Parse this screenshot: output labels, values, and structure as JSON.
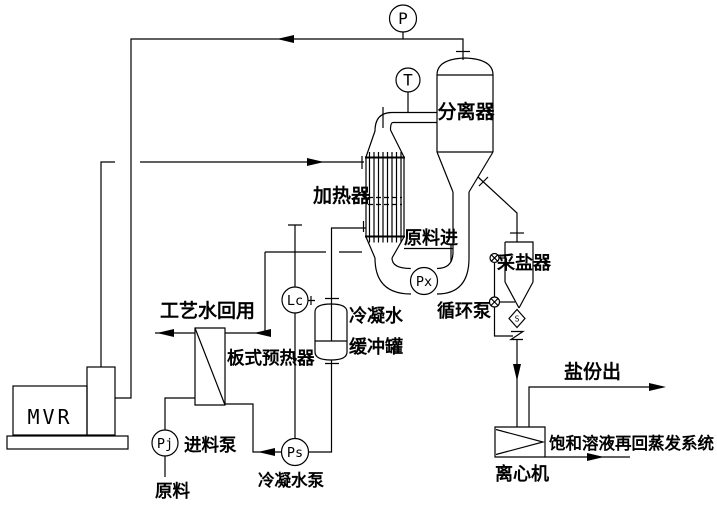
{
  "colors": {
    "line": "#000000",
    "background": "#ffffff"
  },
  "instruments": {
    "pressure": {
      "tag": "P"
    },
    "temperature": {
      "tag": "T"
    },
    "circulation_pump": {
      "tag": "Px",
      "label": "循环泵"
    },
    "level_controller": {
      "tag": "Lc"
    },
    "condensate_pump": {
      "tag": "Ps",
      "label": "冷凝水泵"
    },
    "feed_pump": {
      "tag": "Pj",
      "label": "进料泵"
    }
  },
  "equipment": {
    "mvr": {
      "label": "MVR"
    },
    "heater": {
      "label": "加热器"
    },
    "separator": {
      "label": "分离器"
    },
    "plate_preheater": {
      "label": "板式预热器"
    },
    "condensate_buffer_tank": {
      "label_line1": "冷凝水",
      "label_line2": "缓冲罐"
    },
    "salt_collector": {
      "label": "采盐器"
    },
    "centrifuge": {
      "label": "离心机"
    }
  },
  "streams": {
    "feed_in": {
      "label": "原料进"
    },
    "raw_material": {
      "label": "原料"
    },
    "process_water_reuse": {
      "label": "工艺水回用"
    },
    "salt_out": {
      "label": "盐份出"
    },
    "saturated_solution_return": {
      "label": "饱和溶液再回蒸发系统"
    }
  },
  "valve_symbol": {
    "label": "S"
  }
}
